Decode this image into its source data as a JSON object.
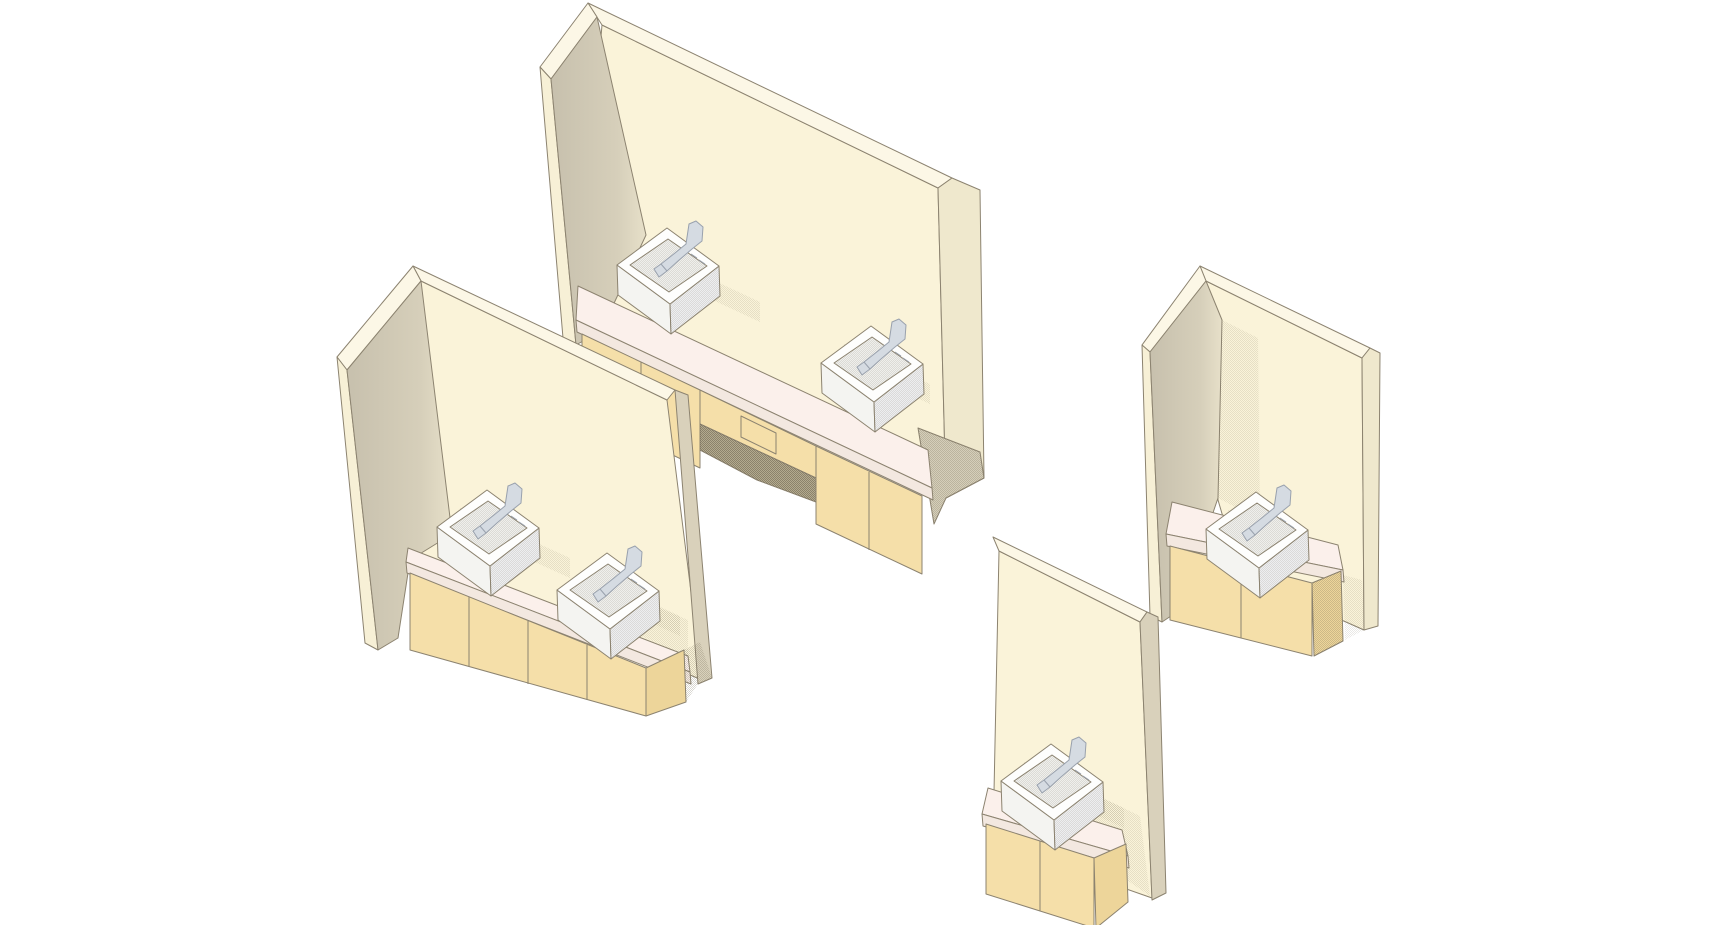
{
  "app": {
    "type": "3d-cad-isometric-render",
    "description": "Isometric 3D rendering of four wall-mounted lavatory vanity configurations on a white background"
  },
  "colors": {
    "background": "#FFFFFF",
    "outline": "#8C8370",
    "wall_face": "#FAF3D9",
    "wall_top": "#FCF7E6",
    "wall_end": "#EFE8CD",
    "wall_end_dark": "#D9D1BB",
    "return_end": "#F7F0D6",
    "return_inner_a": "#C7C0AD",
    "return_inner_b": "#E7E0C9",
    "under_wedge": "#D5CEB9",
    "cabinet_face": "#F5DFA9",
    "cabinet_end": "#EDD59A",
    "counter_top": "#FBF0EB",
    "counter_edge": "#F3E8E0",
    "sink_white": "#FEFEFD",
    "sink_shade_left": "#F4F4F1",
    "sink_shade_right": "#EDEEF0",
    "sink_basin": "#EFEFEC",
    "faucet_fill": "#D5DBE2",
    "faucet_stroke": "#99A1AD",
    "shadow_ink": "#6E6652"
  },
  "scene": {
    "background": "#FFFFFF",
    "projection": "isometric-perspective",
    "units": [
      {
        "id": "ada-double-sink-counter",
        "label": "Large wall panel with two drop-in sinks and open knee space at center",
        "sinks": 2,
        "position": "top-center"
      },
      {
        "id": "double-sink-vanity",
        "label": "Wall panel with two drop-in sinks on a four-door base cabinet",
        "sinks": 2,
        "position": "left"
      },
      {
        "id": "single-sink-vanity",
        "label": "Narrow wall panel with a single drop-in sink on a two-door base cabinet",
        "sinks": 1,
        "position": "bottom-center"
      },
      {
        "id": "single-sink-counter",
        "label": "Wall panel with a single drop-in sink, counter extending past wall edge",
        "sinks": 1,
        "position": "right"
      }
    ]
  }
}
